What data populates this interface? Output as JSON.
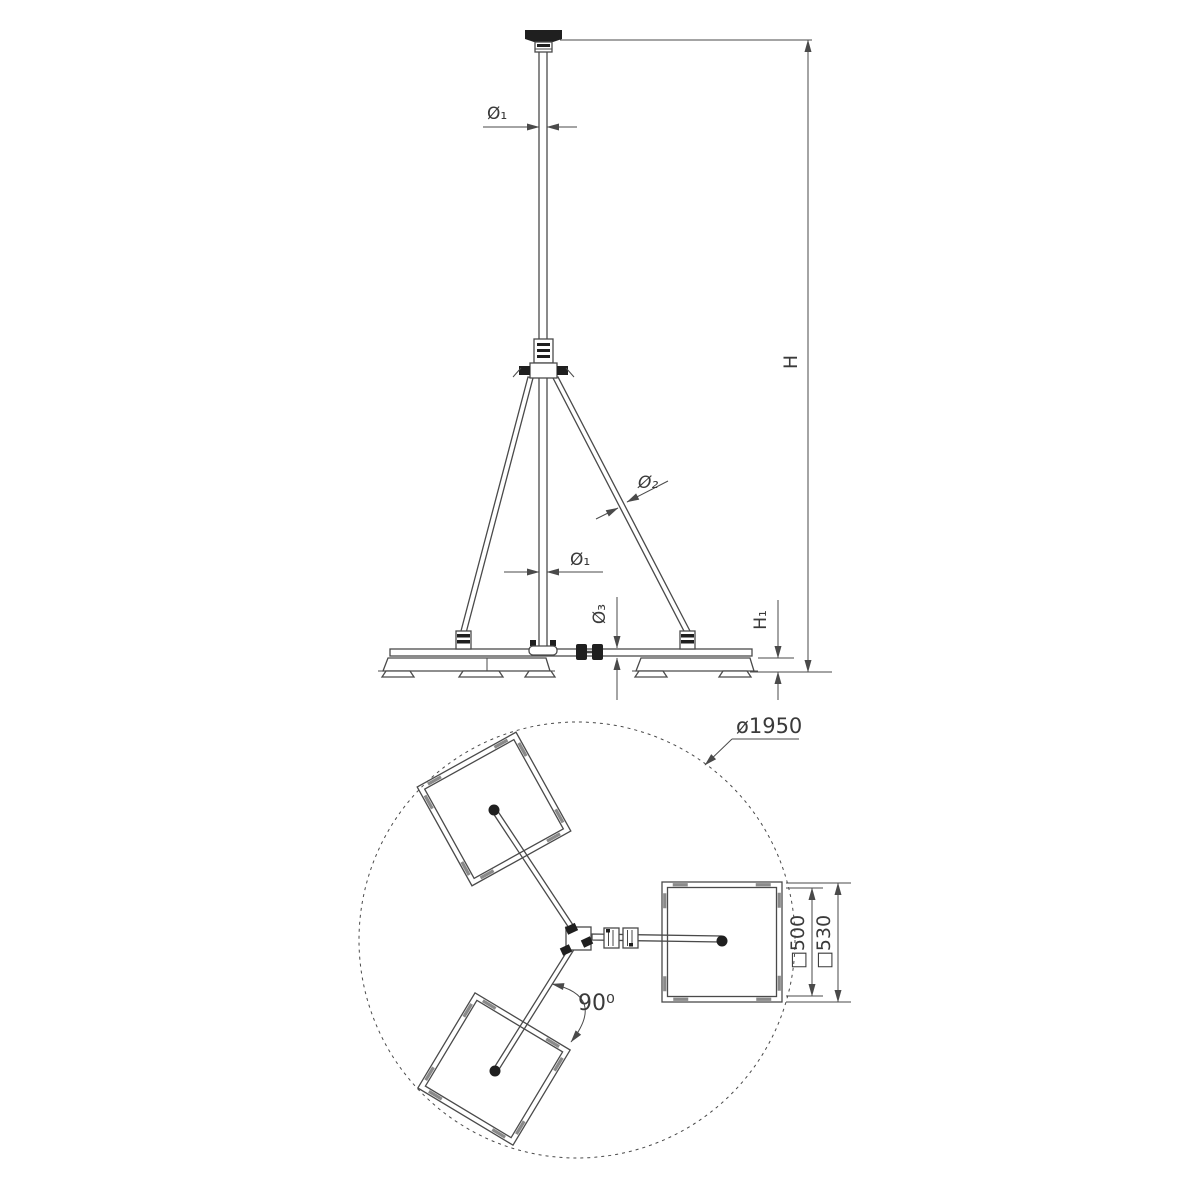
{
  "drawing": {
    "colors": {
      "line": "#4a4a4a",
      "text": "#3a3a3a",
      "dark_fill": "#1f1f1f",
      "frame_shade": "#8a8a8a",
      "background": "#ffffff"
    },
    "elevation": {
      "labels": {
        "dia1_top": "Ø₁",
        "dia1_mid": "Ø₁",
        "dia2": "Ø₂",
        "dia3": "Ø₃",
        "height": "H",
        "base_height": "H₁"
      }
    },
    "plan": {
      "labels": {
        "circle_dia": "ø1950",
        "angle": "90⁰",
        "plate_inner": "□500",
        "plate_outer": "□530"
      }
    }
  }
}
